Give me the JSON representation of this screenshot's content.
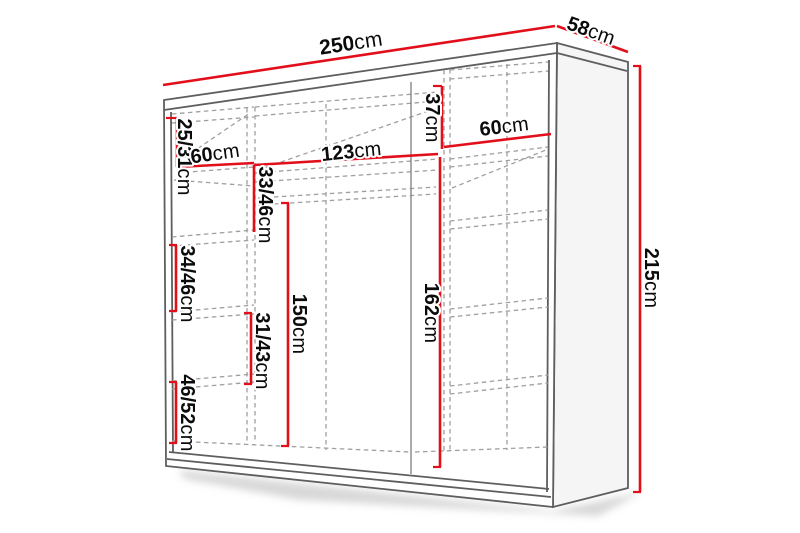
{
  "diagram": {
    "kind": "wardrobe-dimension-diagram",
    "colors": {
      "dimension_red": "#e20f1b",
      "outline_grey": "#5e5e5e",
      "inner_grey": "#858585",
      "dashed_grey": "#9f9f9f",
      "label_text": "#0b0b0b",
      "side_face_fill": "#f5f5f5",
      "background": "#ffffff"
    },
    "dimensions": {
      "total_width": {
        "value": "250",
        "unit": "cm"
      },
      "total_depth": {
        "value": "58",
        "unit": "cm"
      },
      "total_height": {
        "value": "215",
        "unit": "cm"
      },
      "left_top_compartment": {
        "value": "25/31",
        "unit": "cm"
      },
      "left_section_width": {
        "value": "60",
        "unit": "cm"
      },
      "left_compartment_2": {
        "value": "33/46",
        "unit": "cm"
      },
      "middle_section_width": {
        "value": "123",
        "unit": "cm"
      },
      "middle_top_compartment": {
        "value": "37",
        "unit": "cm"
      },
      "right_section_width": {
        "value": "60",
        "unit": "cm"
      },
      "left_compartment_3": {
        "value": "34/46",
        "unit": "cm"
      },
      "left_compartment_4": {
        "value": "31/43",
        "unit": "cm"
      },
      "left_compartment_5": {
        "value": "46/52",
        "unit": "cm"
      },
      "hanging_space_height": {
        "value": "150",
        "unit": "cm"
      },
      "right_inner_height": {
        "value": "162",
        "unit": "cm"
      }
    }
  }
}
